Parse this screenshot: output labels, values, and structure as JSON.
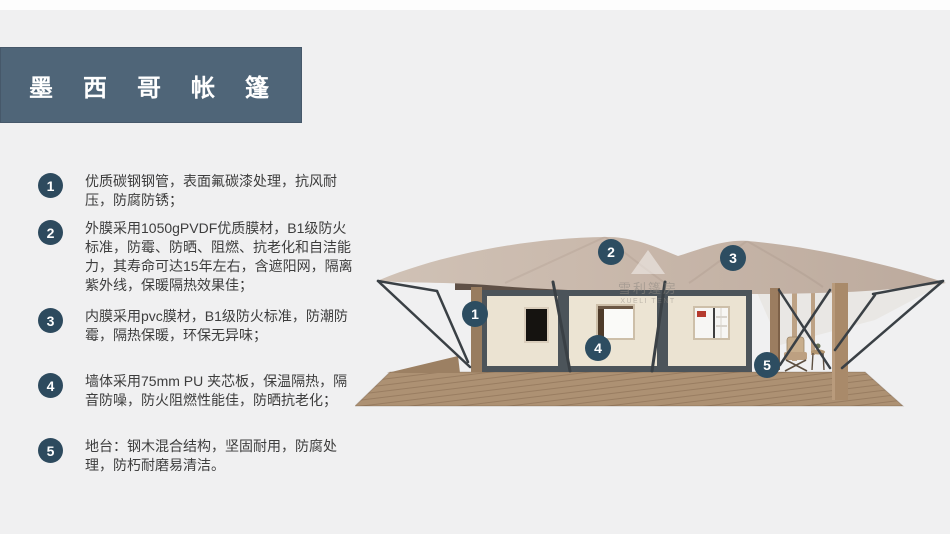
{
  "header": {
    "title": "墨西哥帐篷"
  },
  "features": [
    {
      "num": "1",
      "text": "优质碳钢钢管，表面氟碳漆处理，抗风耐压，防腐防锈；"
    },
    {
      "num": "2",
      "text": "外膜采用1050gPVDF优质膜材，B1级防火标准，防霉、防晒、阻燃、抗老化和自洁能力，其寿命可达15年左右，含遮阳网，隔离紫外线，保暖隔热效果佳；"
    },
    {
      "num": "3",
      "text": "内膜采用pvc膜材，B1级防火标准，防潮防霉，隔热保暖，环保无异味；"
    },
    {
      "num": "4",
      "text": "墙体采用75mm PU 夹芯板，保温隔热，隔音防噪，防火阻燃性能佳，防晒抗老化；"
    },
    {
      "num": "5",
      "text": "地台：钢木混合结构，坚固耐用，防腐处理，防朽耐磨易清洁。"
    }
  ],
  "illustration": {
    "callouts": [
      {
        "num": "1",
        "target": "steel-tube-frame"
      },
      {
        "num": "2",
        "target": "outer-membrane"
      },
      {
        "num": "3",
        "target": "inner-membrane"
      },
      {
        "num": "4",
        "target": "wall-panel"
      },
      {
        "num": "5",
        "target": "deck-platform"
      }
    ],
    "watermark": {
      "line1": "雪利篷房",
      "line2": "XUELI TENT"
    }
  },
  "colors": {
    "background": "#f0f0f1",
    "title_banner": "#4f6578",
    "badge": "#2d4a5e",
    "callout": "#2d4d61",
    "body_text": "#3d3d3d",
    "roof_tan": "#c7b6a9",
    "wall_cream": "#ebe3d2",
    "frame_gray": "#4c545a",
    "deck_wood": "#ad9173"
  }
}
